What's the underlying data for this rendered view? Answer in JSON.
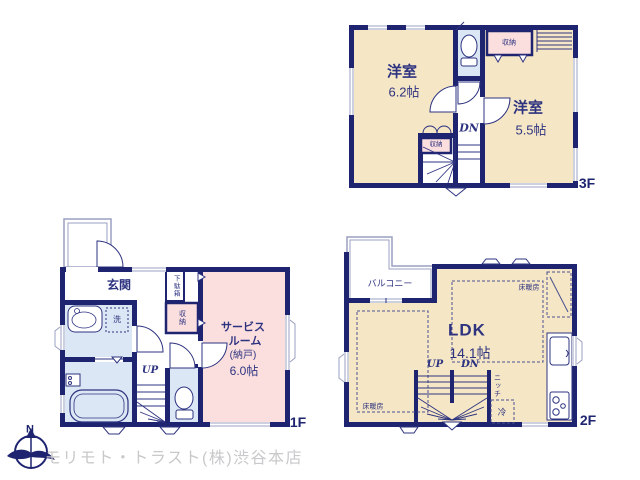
{
  "floor3": {
    "name": "3F",
    "room1_name": "洋室",
    "room1_size": "6.2帖",
    "room2_name": "洋室",
    "room2_size": "5.5帖",
    "closet_top": "収納",
    "closet_stairs": "収納",
    "stairs_down": "DN"
  },
  "floor2": {
    "name": "2F",
    "balcony": "バルコニー",
    "ldk_name": "LDK",
    "ldk_size": "14.1帖",
    "floor_heating_right": "床暖房",
    "floor_heating_left": "床暖房",
    "stairs_up": "UP",
    "stairs_down": "DN",
    "niche": "ニッチ",
    "fridge": "冷"
  },
  "floor1": {
    "name": "1F",
    "entrance": "玄関",
    "shoe_box": "下駄箱",
    "closet": "収納",
    "laundry": "洗",
    "service_room_line1": "サービス",
    "service_room_line2": "ルーム",
    "service_room_line3": "(納戸)",
    "service_room_line4": "6.0帖",
    "stairs_up": "UP"
  },
  "compass": {
    "north": "N"
  },
  "footer": {
    "company": "モリモト・トラスト(株)渋谷本店"
  },
  "colors": {
    "wall_navy": "#1f2470",
    "text_navy": "#2e3380",
    "room_beige": "#f5e7c6",
    "storage_pink": "#fbdfdf",
    "wet_area_blue": "#dbe7f4",
    "watermark_gray": "#c9c9cb"
  }
}
